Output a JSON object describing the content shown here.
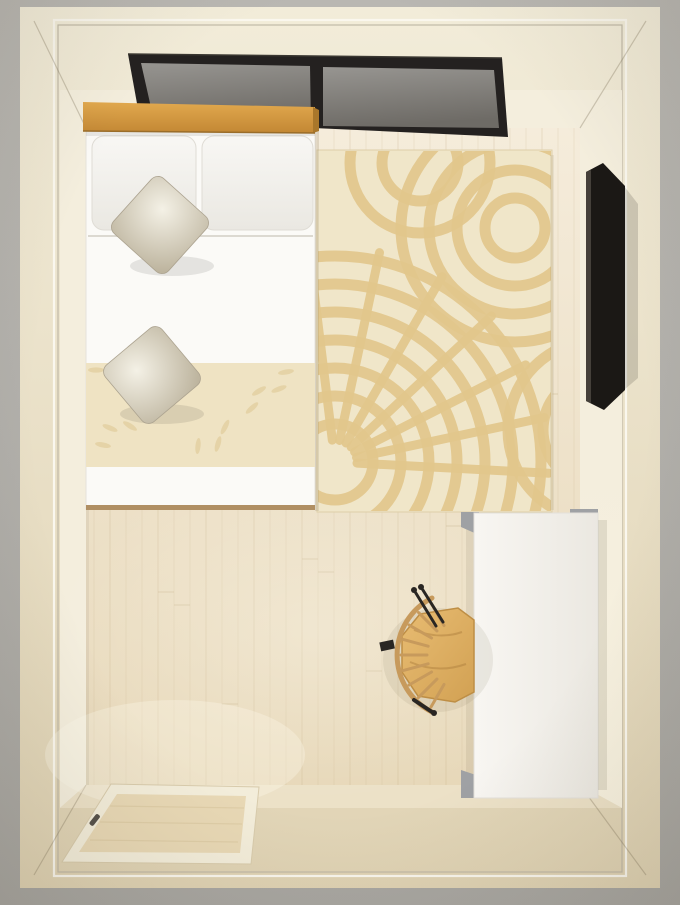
{
  "image": {
    "kind": "3d-room-render-top-view",
    "subject": "bedroom"
  },
  "palette": {
    "bg_outer": "#A9A7A2",
    "bg_outer_light": "#B9B7B2",
    "wall_top": "#F2ECD9",
    "wall_top_dark": "#E0D3B4",
    "trim_light": "#FAF7EE",
    "trim_gray": "#C1BAA8",
    "wall_face": "#F4EEDD",
    "wall_face_dark": "#ECE1C7",
    "floor": "#F5ECDB",
    "floor_dark": "#E7D8B9",
    "plank": "#BFA87E",
    "bed_white": "#FBFAF7",
    "bed_line": "#DCD9D1",
    "bed_frame": "#B08F63",
    "pillow_light": "#F8F7F4",
    "pillow_dark": "#EAE8E2",
    "pillow_edge": "#DFDCD5",
    "satin_light": "#F4F1E6",
    "satin_dark": "#BDB49E",
    "satin_edge": "#ACA390",
    "band": "#EFE3C3",
    "band_motif": "#E3D0A2",
    "headboard": "#E2A94E",
    "headboard_dark": "#C38734",
    "headboard_cap": "#A9772B",
    "window_frame": "#242120",
    "glass_light": "#979591",
    "glass_dark": "#6E6B66",
    "rug": "#F0E6C9",
    "rug_pattern": "#E2C78C",
    "rug_edge": "#DECFA9",
    "tv": "#1B1815",
    "tv_edge": "#45403A",
    "wardrobe": "#F8F6F2",
    "wardrobe_shade": "#EBE8E1",
    "bracket": "#9FA1A4",
    "table": "#E8BC72",
    "table_dark": "#D2A153",
    "table_edge": "#BE8E45",
    "chair": "#C79A5C",
    "black": "#292623",
    "door_frame": "#F3EDDA",
    "door": "#E8D8B5",
    "door_streak": "#D9C69E",
    "handle": "#57524B"
  },
  "objects": {
    "window": "double-pane ceiling window, dark frame",
    "headboard": "wood headboard bar",
    "bed": "double bed, white duvet, patterned runner, 2 pillows, 2 satin cushions",
    "rug": "cream rug with tan swirl pattern",
    "tv": "flat tv on right wall",
    "wardrobe": "white wardrobe / desk block",
    "table": "round wooden table",
    "chair": "spindle-back wooden chair",
    "door": "open door lying over bottom-left threshold",
    "floor": "light wood plank floor"
  }
}
